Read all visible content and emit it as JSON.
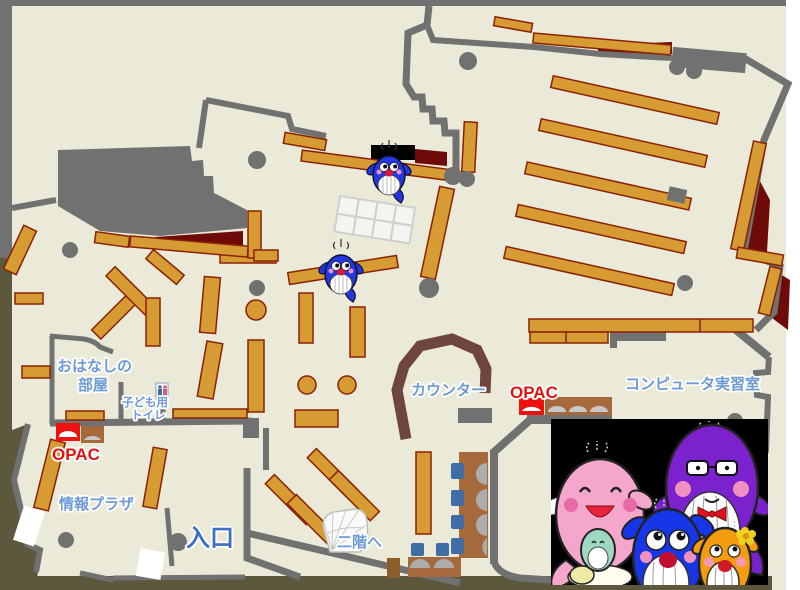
{
  "map": {
    "title": "library-first-floor-map",
    "colors": {
      "floor": "#EBEAD9",
      "wall": "#717171",
      "outside": "#5C583E",
      "shelf": "#D79B33",
      "shelf_border": "#8B2104",
      "closet": "#6E0B08",
      "counter": "#6E4541",
      "label_blue": "#6D99D6",
      "entrance_blue": "#3D6FC8",
      "opac_red": "#E81010",
      "photo_background": "#000000"
    },
    "labels": {
      "storytelling_room": {
        "line1": "おはなしの",
        "line2": "部屋"
      },
      "kids_toilet": {
        "line1": "子ども用",
        "line2": "トイレ"
      },
      "opac_left": "OPAC",
      "info_plaza": "情報プラザ",
      "entrance": "入口",
      "to_second_floor": "二階へ",
      "counter": "カウンター",
      "opac_center": "OPAC",
      "computer_room": "コンピュータ実習室"
    },
    "mascots": {
      "on_map": [
        "blue-whale-mascot",
        "blue-whale-mascot"
      ],
      "photo_characters": [
        "pink-whale-mascot",
        "blue-whale-mascot",
        "purple-whale-mascot",
        "orange-whale-mascot"
      ]
    }
  }
}
